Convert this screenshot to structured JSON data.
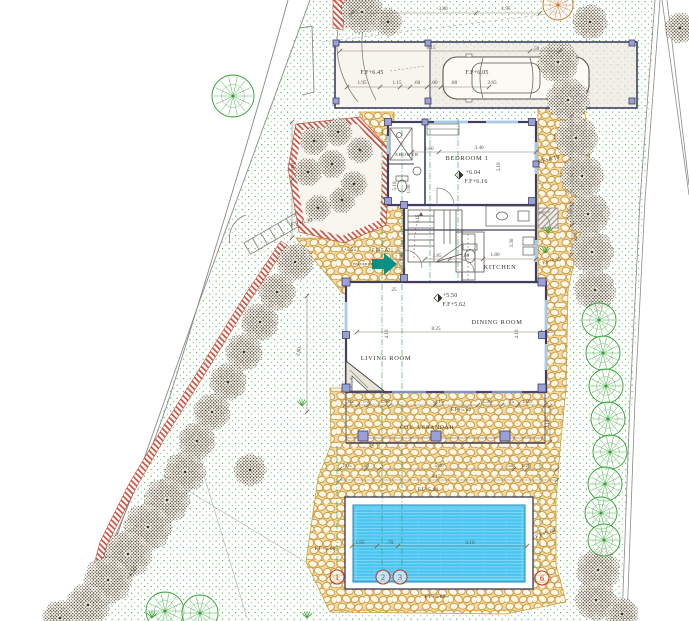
{
  "drawing": {
    "type": "architectural-site-plan",
    "colors": {
      "paving_mortar": "#cf9838",
      "paving_bg": "#f1d9a0",
      "lawn_dot": "#3fae46",
      "pool_water": "#4ac4f0",
      "pool_line": "#86dcf8",
      "wall_dark": "#403f60",
      "column_fill": "#9aa0d8",
      "boundary_red": "#c9503c",
      "tree_dark": "#473f34",
      "tree_green": "#2f9e2f",
      "tree_autumn": "#c96a28",
      "dim_text": "#55503f",
      "section_green": "#2ca04f",
      "marker_red": "#c8382a",
      "entrance_teal": "#0a8f86"
    },
    "rooms": [
      {
        "label": "SHOWER",
        "x": 407,
        "y": 156,
        "s": 4.6
      },
      {
        "label": "BEDROOM 1",
        "x": 467,
        "y": 160,
        "s": 6.4
      },
      {
        "label": "KITCHEN",
        "x": 500,
        "y": 269,
        "s": 6.4
      },
      {
        "label": "DINING ROOM",
        "x": 497,
        "y": 324,
        "s": 6.4
      },
      {
        "label": "LIVING ROOM",
        "x": 386,
        "y": 360,
        "s": 6.4
      },
      {
        "label": "COV. VERANDAH",
        "x": 427,
        "y": 429,
        "s": 5.6
      },
      {
        "label": "entrance",
        "x": 363,
        "y": 265,
        "s": 4.4
      }
    ],
    "levels": [
      {
        "label": "+6.04",
        "x": 473,
        "y": 174,
        "s": 6
      },
      {
        "label": "F.F+6.16",
        "x": 476,
        "y": 183,
        "s": 6
      },
      {
        "label": "+5.50",
        "x": 450,
        "y": 297,
        "s": 6
      },
      {
        "label": "F.F+5.62",
        "x": 454,
        "y": 306,
        "s": 6
      },
      {
        "label": "F.F+6.45",
        "x": 372,
        "y": 74,
        "s": 6
      },
      {
        "label": "F.F+6.05",
        "x": 477,
        "y": 74,
        "s": 6
      },
      {
        "label": "F.F+6.10",
        "x": 549,
        "y": 161,
        "s": 5.8,
        "r": -14
      },
      {
        "label": "F.F+6.30",
        "x": 302,
        "y": 224,
        "s": 5.8,
        "r": -14
      },
      {
        "label": "F.F+5.52",
        "x": 461,
        "y": 411,
        "s": 5.4
      },
      {
        "label": "F.F+5.60",
        "x": 428,
        "y": 491,
        "s": 5.4
      },
      {
        "label": "F.F+5.60",
        "x": 325,
        "y": 550,
        "s": 5.4
      },
      {
        "label": "F.F+5.60",
        "x": 546,
        "y": 535,
        "s": 5.4,
        "r": -20
      },
      {
        "label": "F.F+5.60",
        "x": 435,
        "y": 598,
        "s": 5.4
      },
      {
        "label": "+5.55",
        "x": 350,
        "y": 251,
        "s": 4.8
      },
      {
        "label": "F.F+5.67",
        "x": 381,
        "y": 252,
        "s": 4.8
      },
      {
        "label": "F.F+5.55",
        "x": 552,
        "y": 262,
        "s": 4.8,
        "r": -14
      },
      {
        "label": "+4.50",
        "x": 133,
        "y": 574,
        "s": 6,
        "r": -55
      }
    ],
    "dims": [
      {
        "t": "3.80",
        "x": 443,
        "y": 10
      },
      {
        "t": "1.95",
        "x": 506,
        "y": 10
      },
      {
        "t": "8.15",
        "x": 431,
        "y": 49
      },
      {
        "t": ".50",
        "x": 536,
        "y": 50
      },
      {
        "t": "1.95",
        "x": 362,
        "y": 84
      },
      {
        "t": "1.15",
        "x": 397,
        "y": 84
      },
      {
        "t": ".60",
        "x": 417,
        "y": 84
      },
      {
        "t": "1.00",
        "x": 433,
        "y": 84
      },
      {
        "t": ".80",
        "x": 454,
        "y": 84
      },
      {
        "t": "2.85",
        "x": 492,
        "y": 84
      },
      {
        "t": "1.60",
        "x": 429,
        "y": 150
      },
      {
        "t": "3.40",
        "x": 479,
        "y": 149
      },
      {
        "t": "3.10",
        "x": 500,
        "y": 167,
        "r": -90
      },
      {
        "t": "5.10",
        "x": 396,
        "y": 186,
        "r": -90
      },
      {
        "t": "1.00",
        "x": 410,
        "y": 189,
        "r": -90
      },
      {
        "t": "1.15",
        "x": 419,
        "y": 219,
        "r": -90
      },
      {
        "t": "1.40",
        "x": 403,
        "y": 257,
        "r": -90
      },
      {
        "t": "1.85",
        "x": 437,
        "y": 257
      },
      {
        "t": ".80",
        "x": 466,
        "y": 257
      },
      {
        "t": "1.80",
        "x": 495,
        "y": 256
      },
      {
        "t": "3.30",
        "x": 513,
        "y": 243,
        "r": -90
      },
      {
        "t": "8.25",
        "x": 436,
        "y": 330
      },
      {
        "t": "4.10",
        "x": 388,
        "y": 334,
        "r": -90
      },
      {
        "t": "4.10",
        "x": 518,
        "y": 334,
        "r": -90
      },
      {
        "t": "25",
        "x": 550,
        "y": 333
      },
      {
        "t": "25",
        "x": 394,
        "y": 291
      },
      {
        "t": "2.80",
        "x": 300,
        "y": 352,
        "r": -75
      },
      {
        "t": "3.60",
        "x": 294,
        "y": 168,
        "r": -75
      },
      {
        "t": ".75",
        "x": 572,
        "y": 193,
        "r": -90
      },
      {
        "t": "1.60",
        "x": 572,
        "y": 213,
        "r": -90
      },
      {
        "t": "1.20",
        "x": 577,
        "y": 237,
        "r": -90
      },
      {
        "t": "1.05",
        "x": 349,
        "y": 403
      },
      {
        "t": ".70",
        "x": 366,
        "y": 403
      },
      {
        "t": "1.80",
        "x": 385,
        "y": 403
      },
      {
        "t": "2.15",
        "x": 439,
        "y": 403
      },
      {
        "t": "1.90",
        "x": 487,
        "y": 403
      },
      {
        "t": ".75",
        "x": 511,
        "y": 403
      },
      {
        "t": "1.05",
        "x": 527,
        "y": 403
      },
      {
        "t": "2.10",
        "x": 549,
        "y": 424,
        "r": -90
      },
      {
        "t": "90",
        "x": 374,
        "y": 445,
        "r": -90
      },
      {
        "t": "1.05",
        "x": 347,
        "y": 467
      },
      {
        "t": ".50",
        "x": 366,
        "y": 467
      },
      {
        "t": "5.40",
        "x": 439,
        "y": 467
      },
      {
        "t": ".50",
        "x": 510,
        "y": 467
      },
      {
        "t": "1.20",
        "x": 526,
        "y": 467
      },
      {
        "t": "8.15",
        "x": 436,
        "y": 478
      },
      {
        "t": "1.95",
        "x": 360,
        "y": 544
      },
      {
        "t": ".70",
        "x": 390,
        "y": 544
      },
      {
        "t": "6.10",
        "x": 470,
        "y": 544
      }
    ],
    "markers": [
      {
        "n": "1",
        "x": 337,
        "y": 577
      },
      {
        "n": "2",
        "x": 383,
        "y": 577
      },
      {
        "n": "3",
        "x": 400,
        "y": 577
      },
      {
        "n": "6",
        "x": 542,
        "y": 578
      }
    ],
    "sections": [
      [
        382,
        130,
        568
      ],
      [
        402,
        130,
        568
      ],
      [
        430,
        118,
        282
      ],
      [
        458,
        118,
        282
      ],
      [
        337,
        446,
        568
      ],
      [
        540,
        452,
        570
      ]
    ],
    "chains": [
      {
        "x1": 352,
        "y1": 13,
        "x2": 540,
        "y2": 13,
        "ticks": [
          352,
          476,
          540
        ]
      },
      {
        "x1": 340,
        "y1": 51,
        "x2": 560,
        "y2": 51,
        "ticks": [
          340,
          530,
          560
        ]
      },
      {
        "x1": 347,
        "y1": 87,
        "x2": 489,
        "y2": 87,
        "ticks": [
          347,
          380,
          400,
          410,
          427,
          441,
          489
        ]
      },
      {
        "x1": 412,
        "y1": 152,
        "x2": 536,
        "y2": 152,
        "ticks": [
          412,
          439,
          536
        ]
      },
      {
        "x1": 425,
        "y1": 259,
        "x2": 536,
        "y2": 259,
        "ticks": [
          425,
          450,
          483,
          536
        ]
      },
      {
        "x1": 357,
        "y1": 332,
        "x2": 540,
        "y2": 332,
        "ticks": [
          357,
          540
        ]
      },
      {
        "x1": 345,
        "y1": 405,
        "x2": 545,
        "y2": 405,
        "ticks": [
          345,
          358,
          368,
          390,
          435,
          478,
          502,
          518,
          545
        ]
      },
      {
        "x1": 340,
        "y1": 469,
        "x2": 557,
        "y2": 469,
        "ticks": [
          340,
          366,
          379,
          514,
          527,
          557
        ]
      },
      {
        "x1": 340,
        "y1": 480,
        "x2": 557,
        "y2": 480,
        "ticks": [
          340,
          557
        ]
      },
      {
        "x1": 352,
        "y1": 546,
        "x2": 527,
        "y2": 546,
        "ticks": [
          352,
          377,
          398,
          527
        ]
      },
      {
        "x1": 572,
        "y1": 115,
        "x2": 572,
        "y2": 255,
        "ticks": [
          115,
          175,
          205,
          225,
          255
        ]
      },
      {
        "x1": 292,
        "y1": 122,
        "x2": 292,
        "y2": 238,
        "ticks": [
          122,
          180,
          238
        ]
      },
      {
        "x1": 307,
        "y1": 296,
        "x2": 307,
        "y2": 412,
        "ticks": [
          296,
          412
        ]
      },
      {
        "x1": 550,
        "y1": 406,
        "x2": 550,
        "y2": 442,
        "ticks": [
          406,
          442
        ]
      }
    ],
    "trees": {
      "dark": [
        [
          362,
          12,
          20
        ],
        [
          388,
          22,
          13
        ],
        [
          590,
          22,
          16
        ],
        [
          680,
          28,
          14
        ],
        [
          558,
          62,
          19
        ],
        [
          568,
          100,
          20
        ],
        [
          576,
          138,
          20
        ],
        [
          582,
          176,
          20
        ],
        [
          588,
          214,
          20
        ],
        [
          592,
          252,
          20
        ],
        [
          595,
          290,
          19
        ],
        [
          598,
          570,
          20
        ],
        [
          596,
          600,
          19
        ],
        [
          622,
          614,
          15
        ],
        [
          295,
          262,
          17
        ],
        [
          277,
          292,
          17
        ],
        [
          260,
          322,
          17
        ],
        [
          244,
          352,
          17
        ],
        [
          228,
          382,
          17
        ],
        [
          212,
          412,
          17
        ],
        [
          197,
          441,
          17
        ],
        [
          250,
          470,
          15
        ],
        [
          185,
          472,
          19
        ],
        [
          167,
          500,
          21
        ],
        [
          148,
          527,
          22
        ],
        [
          128,
          554,
          22
        ],
        [
          108,
          580,
          22
        ],
        [
          88,
          605,
          20
        ],
        [
          60,
          618,
          16
        ]
      ],
      "green": [
        [
          599,
          320,
          17
        ],
        [
          603,
          353,
          17
        ],
        [
          606,
          386,
          17
        ],
        [
          608,
          419,
          17
        ],
        [
          610,
          452,
          17
        ],
        [
          605,
          484,
          17
        ],
        [
          601,
          513,
          16
        ],
        [
          604,
          540,
          16
        ],
        [
          233,
          96,
          21
        ],
        [
          165,
          611,
          19
        ],
        [
          200,
          613,
          18
        ]
      ],
      "autumn": [
        [
          558,
          5,
          15
        ]
      ],
      "shrubs": [
        [
          314,
          141,
          13
        ],
        [
          338,
          132,
          13
        ],
        [
          360,
          150,
          12
        ],
        [
          308,
          172,
          13
        ],
        [
          332,
          164,
          13
        ],
        [
          354,
          184,
          12
        ],
        [
          318,
          208,
          12
        ],
        [
          342,
          200,
          12
        ]
      ]
    },
    "grass": [
      [
        302,
        406
      ],
      [
        548,
        233
      ],
      [
        545,
        253
      ],
      [
        152,
        618
      ],
      [
        307,
        618
      ]
    ],
    "columns": [
      [
        388,
        122,
        7
      ],
      [
        532,
        122,
        7
      ],
      [
        388,
        201,
        7
      ],
      [
        532,
        201,
        7
      ],
      [
        404,
        205,
        7
      ],
      [
        404,
        278,
        7
      ],
      [
        346,
        282,
        8
      ],
      [
        542,
        282,
        8
      ],
      [
        346,
        388,
        8
      ],
      [
        542,
        388,
        8
      ],
      [
        346,
        335,
        7
      ],
      [
        542,
        335,
        7
      ],
      [
        363,
        436,
        10
      ],
      [
        436,
        436,
        10
      ],
      [
        505,
        436,
        10
      ],
      [
        336,
        43,
        6
      ],
      [
        428,
        43,
        6
      ],
      [
        632,
        43,
        6
      ],
      [
        336,
        101,
        6
      ],
      [
        428,
        101,
        6
      ],
      [
        632,
        101,
        6
      ],
      [
        425,
        122,
        6
      ],
      [
        536,
        164,
        6
      ]
    ],
    "nw_stairs": {
      "x1": 244,
      "y1": 243,
      "x2": 320,
      "y2": 199,
      "w": 13,
      "n": 9
    }
  }
}
